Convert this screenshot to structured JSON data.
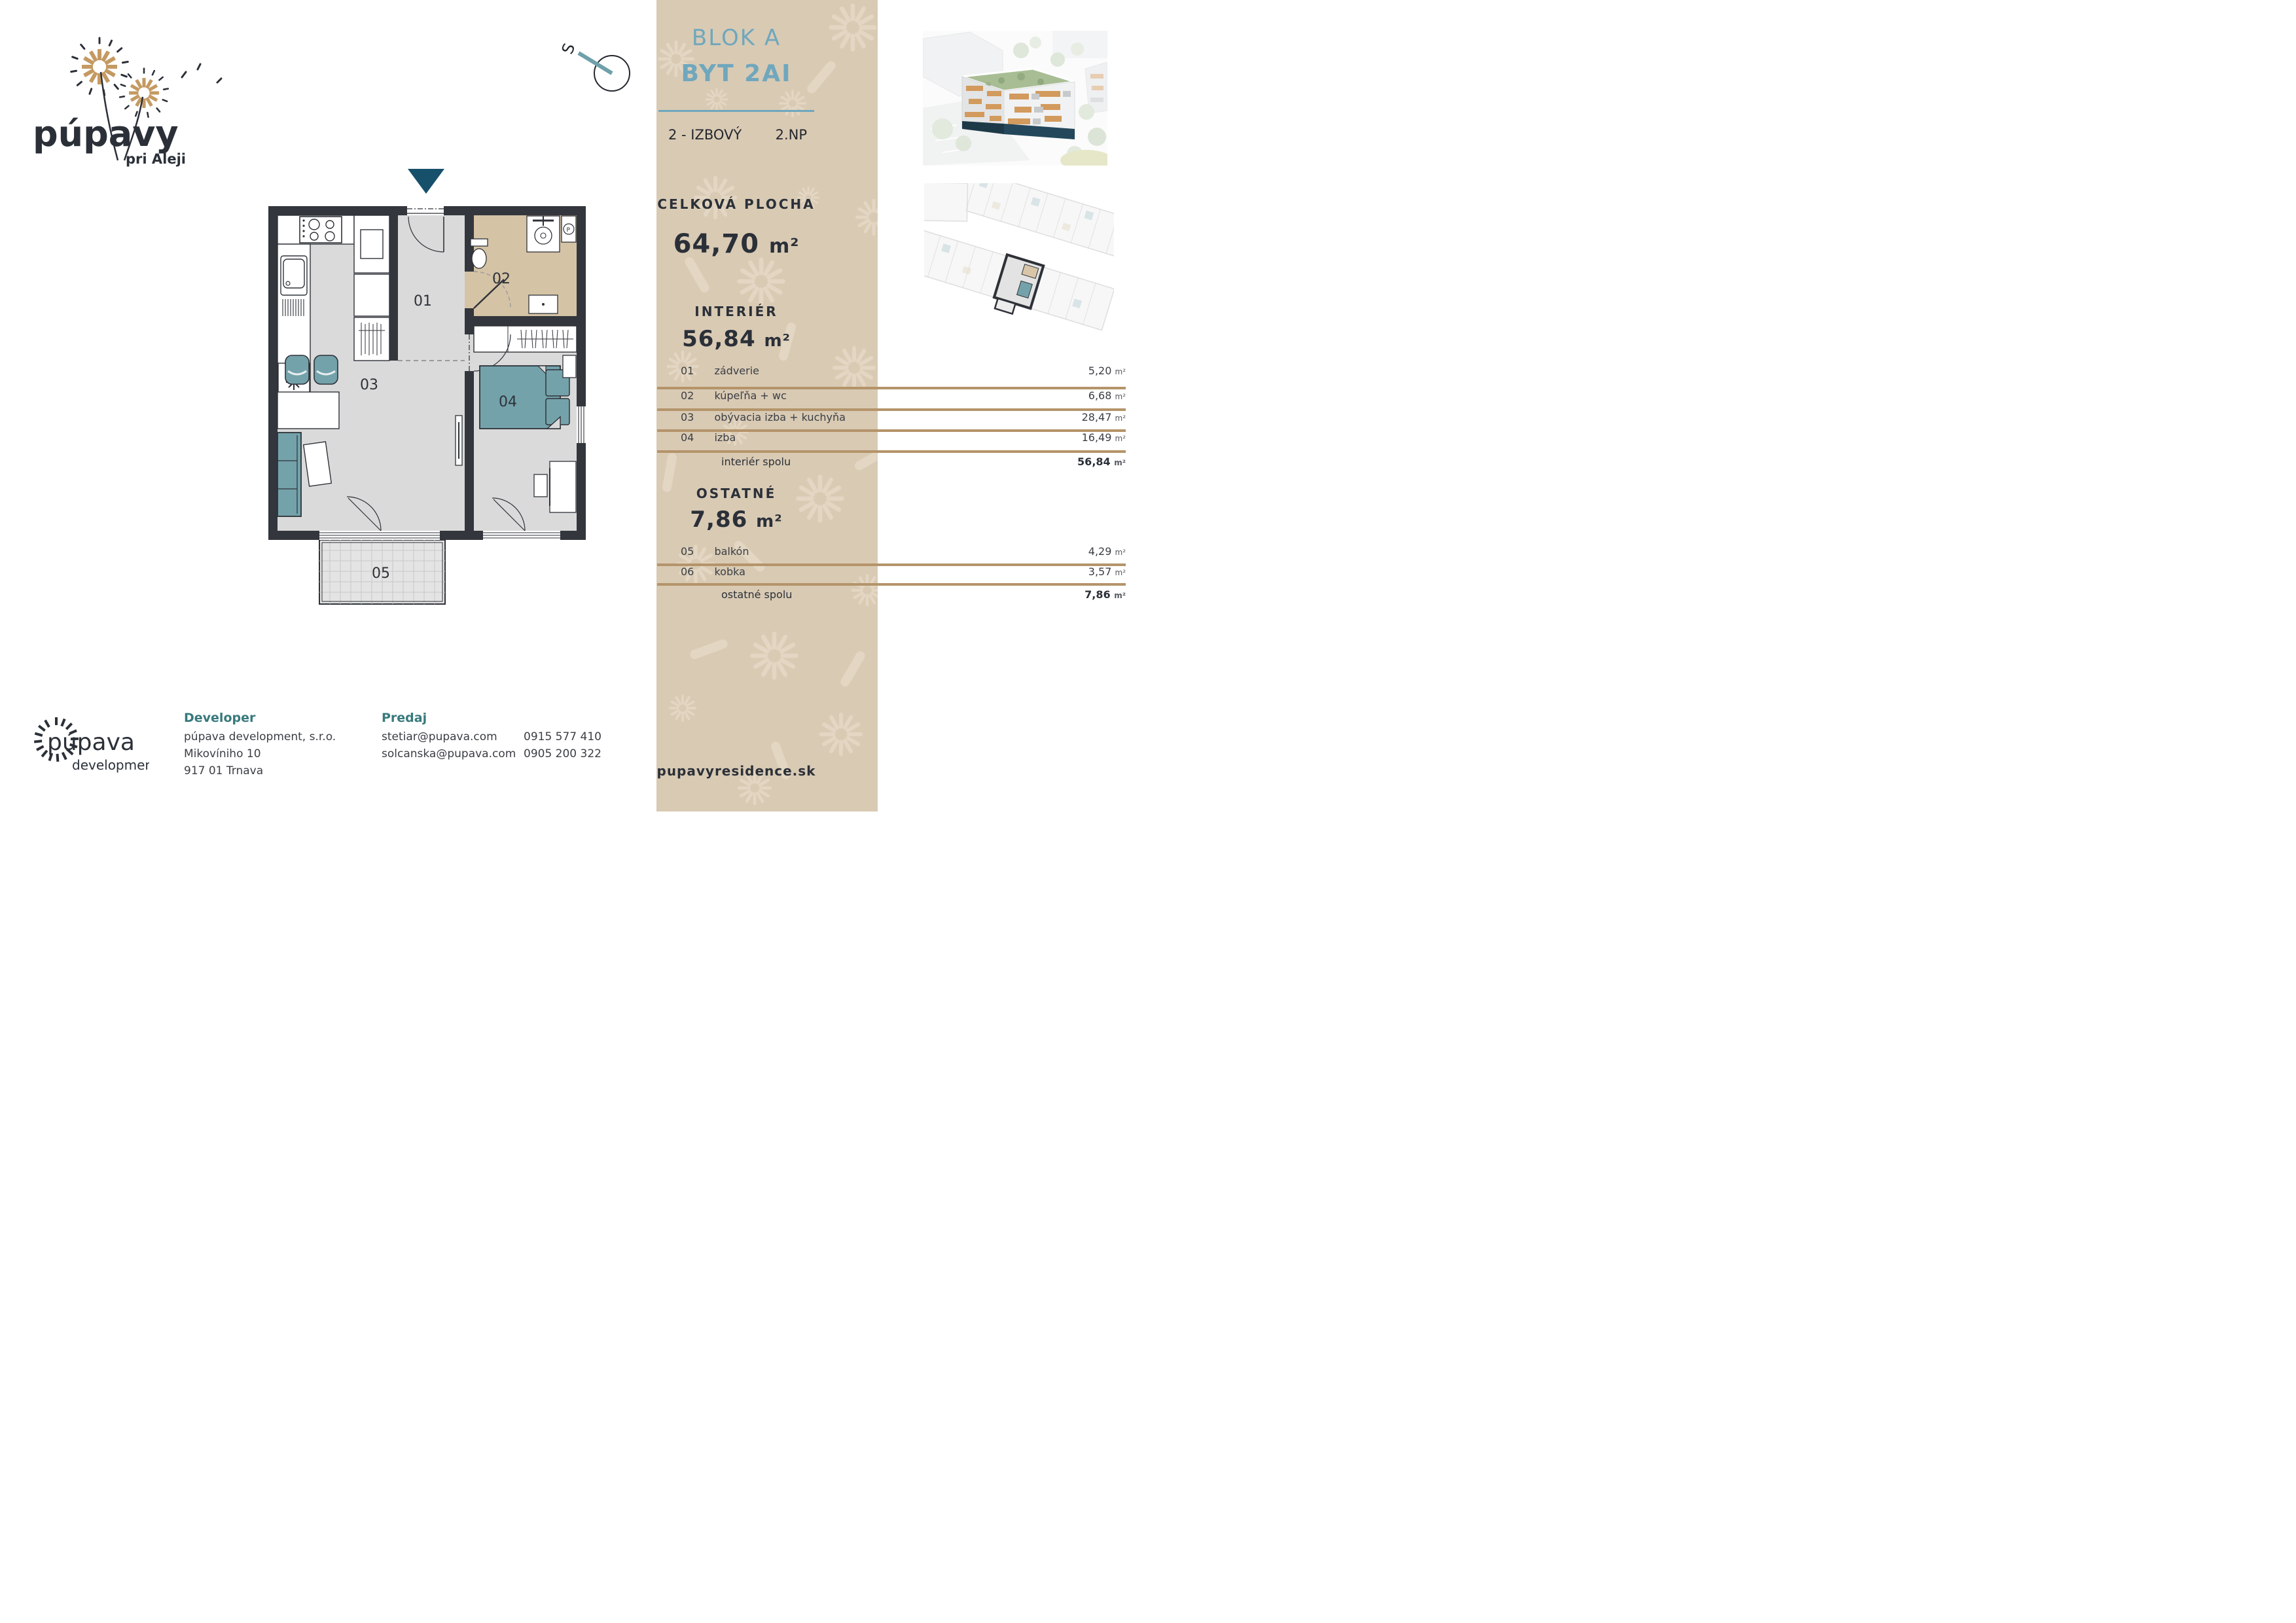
{
  "brand": {
    "logo_title": "púpavy",
    "logo_subtitle": "pri Aleji",
    "compass_label": "S",
    "footer_logo_word1": "púpava",
    "footer_logo_word2": "development"
  },
  "panel": {
    "block_title": "BLOK A",
    "unit_title": "BYT 2AI",
    "type_label": "2 - IZBOVÝ",
    "floor_label": "2.NP",
    "total_area_label": "CELKOVÁ PLOCHA",
    "total_area_value": "64,70",
    "interior_label": "INTERIÉR",
    "interior_value": "56,84",
    "other_label": "OSTATNÉ",
    "other_value": "7,86",
    "website": "pupavyresidence.sk"
  },
  "units": {
    "m2": "m²"
  },
  "tables": {
    "interior": {
      "rows": [
        {
          "num": "01",
          "name": "zádverie",
          "area": "5,20"
        },
        {
          "num": "02",
          "name": "kúpeľňa + wc",
          "area": "6,68"
        },
        {
          "num": "03",
          "name": "obývacia izba + kuchyňa",
          "area": "28,47"
        },
        {
          "num": "04",
          "name": "izba",
          "area": "16,49"
        }
      ],
      "total": {
        "label": "interiér spolu",
        "area": "56,84"
      }
    },
    "other": {
      "rows": [
        {
          "num": "05",
          "name": "balkón",
          "area": "4,29"
        },
        {
          "num": "06",
          "name": "kobka",
          "area": "3,57"
        }
      ],
      "total": {
        "label": "ostatné spolu",
        "area": "7,86"
      }
    }
  },
  "floorplan": {
    "labels": {
      "r01": "01",
      "r02": "02",
      "r03": "03",
      "r04": "04",
      "r05": "05"
    },
    "washer_label": "P"
  },
  "footer": {
    "developer_label": "Developer",
    "developer_lines": [
      "púpava development, s.r.o.",
      "Mikovíniho 10",
      "917 01 Trnava"
    ],
    "sales_label": "Predaj",
    "contacts": [
      {
        "email": "stetiar@pupava.com",
        "phone": "0915 577 410"
      },
      {
        "email": "solcanska@pupava.com",
        "phone": "0905 200 322"
      }
    ]
  },
  "colors": {
    "panel_beige": "#d9cab4",
    "panel_pattern": "#e3d6c2",
    "accent_teal": "#6fa7bd",
    "table_line_tan": "#b4946a",
    "text_navy": "#2b3038",
    "label_teal": "#37797c",
    "plan_wall": "#33363c",
    "plan_floor": "#dadada",
    "plan_bath_floor": "#d5c3a6",
    "plan_furniture_teal": "#74a2ab",
    "entrance_arrow_blue": "#17506b"
  }
}
